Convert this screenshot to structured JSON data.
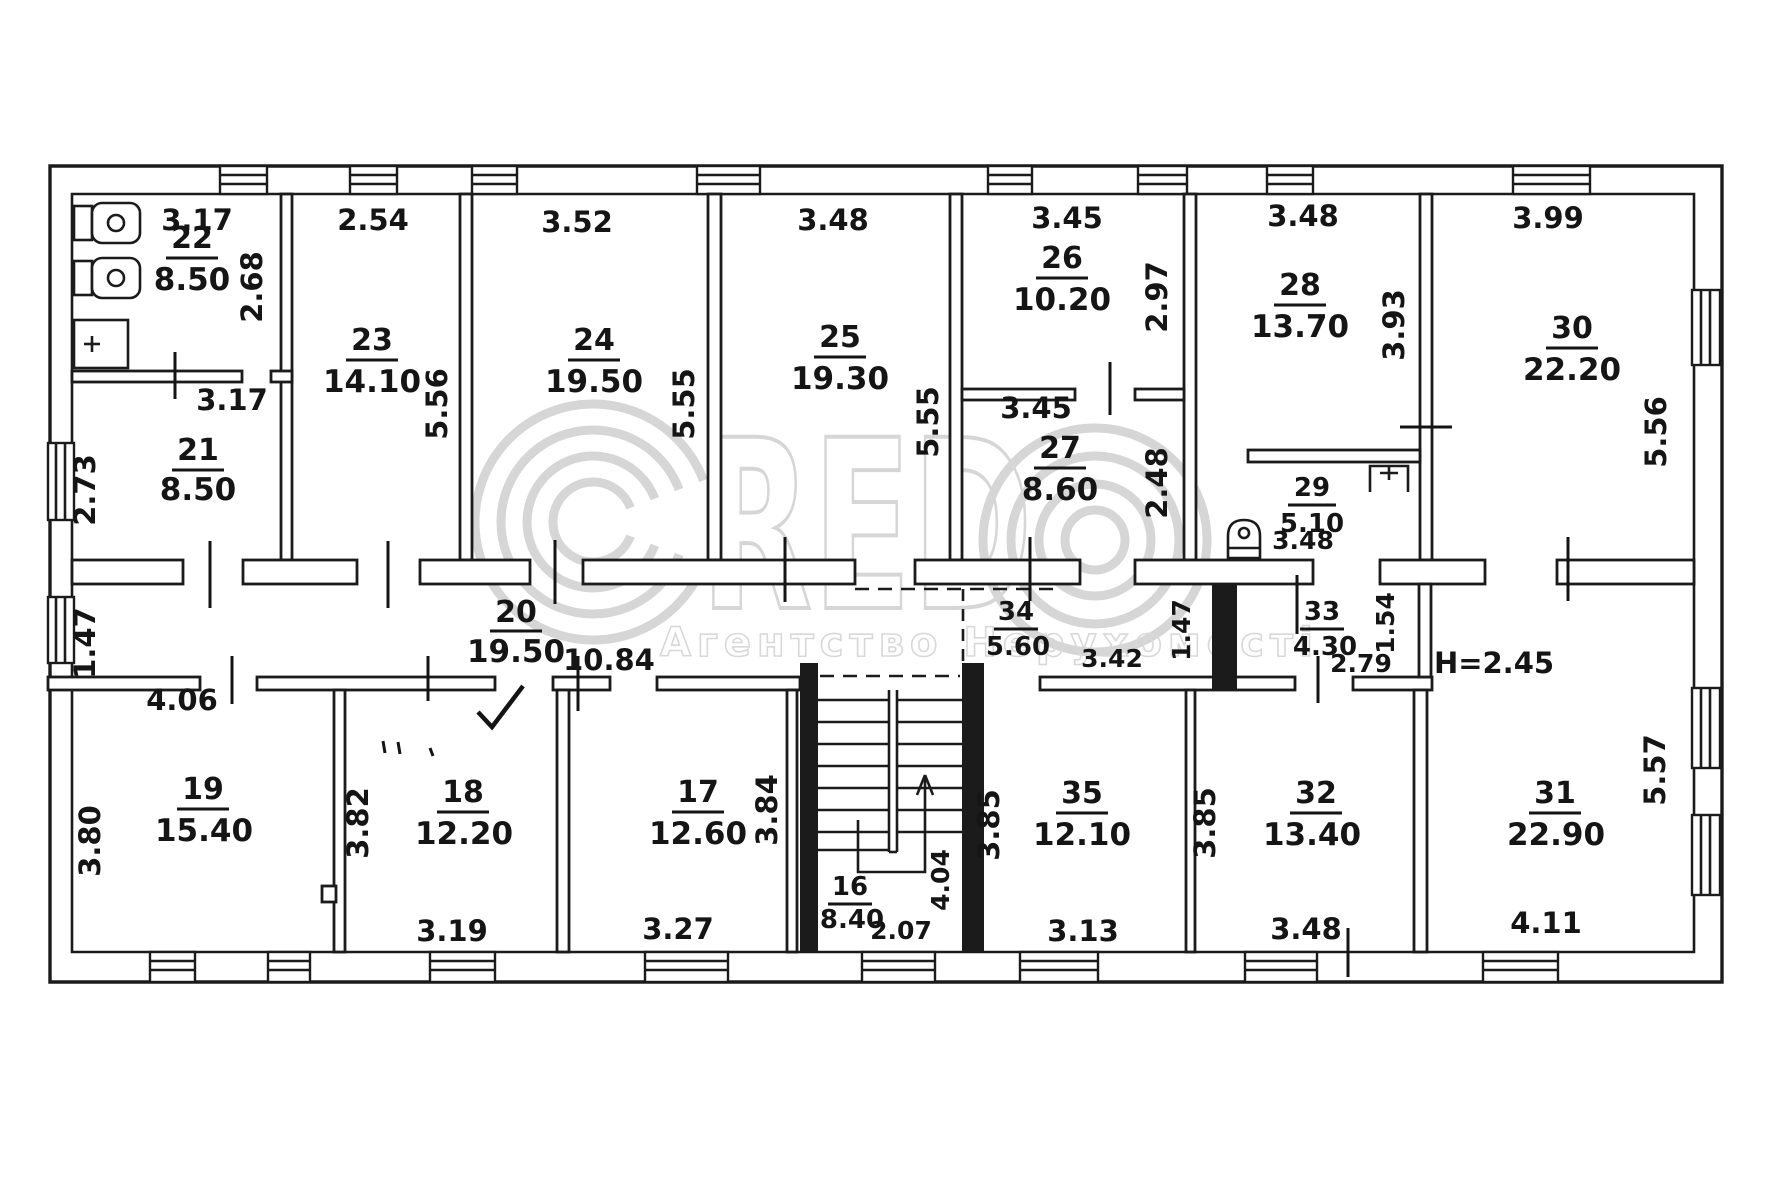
{
  "watermark": {
    "letters": "RED",
    "caption": "Агентство Нерухомості"
  },
  "note_height": "H=2.45",
  "rooms": {
    "r16": {
      "number": "16",
      "area": "8.40"
    },
    "r17": {
      "number": "17",
      "area": "12.60"
    },
    "r18": {
      "number": "18",
      "area": "12.20"
    },
    "r19": {
      "number": "19",
      "area": "15.40"
    },
    "r20": {
      "number": "20",
      "area": "19.50"
    },
    "r21": {
      "number": "21",
      "area": "8.50"
    },
    "r22": {
      "number": "22",
      "area": "8.50"
    },
    "r23": {
      "number": "23",
      "area": "14.10"
    },
    "r24": {
      "number": "24",
      "area": "19.50"
    },
    "r25": {
      "number": "25",
      "area": "19.30"
    },
    "r26": {
      "number": "26",
      "area": "10.20"
    },
    "r27": {
      "number": "27",
      "area": "8.60"
    },
    "r28": {
      "number": "28",
      "area": "13.70"
    },
    "r29": {
      "number": "29",
      "area": "5.10"
    },
    "r30": {
      "number": "30",
      "area": "22.20"
    },
    "r31": {
      "number": "31",
      "area": "22.90"
    },
    "r32": {
      "number": "32",
      "area": "13.40"
    },
    "r33": {
      "number": "33",
      "area": "4.30"
    },
    "r34": {
      "number": "34",
      "area": "5.60"
    },
    "r35": {
      "number": "35",
      "area": "12.10"
    }
  },
  "dims": [
    "3.17",
    "2.54",
    "3.52",
    "3.48",
    "3.45",
    "3.48",
    "3.99",
    "2.68",
    "3.17",
    "2.73",
    "5.56",
    "5.55",
    "5.55",
    "2.97",
    "3.45",
    "2.48",
    "3.93",
    "3.48",
    "5.56",
    "1.47",
    "10.84",
    "4.06",
    "3.80",
    "3.42",
    "1.47",
    "2.79",
    "1.54",
    "3.82",
    "3.19",
    "3.84",
    "3.27",
    "2.07",
    "4.04",
    "3.85",
    "3.13",
    "3.85",
    "3.48",
    "4.11",
    "5.57"
  ]
}
